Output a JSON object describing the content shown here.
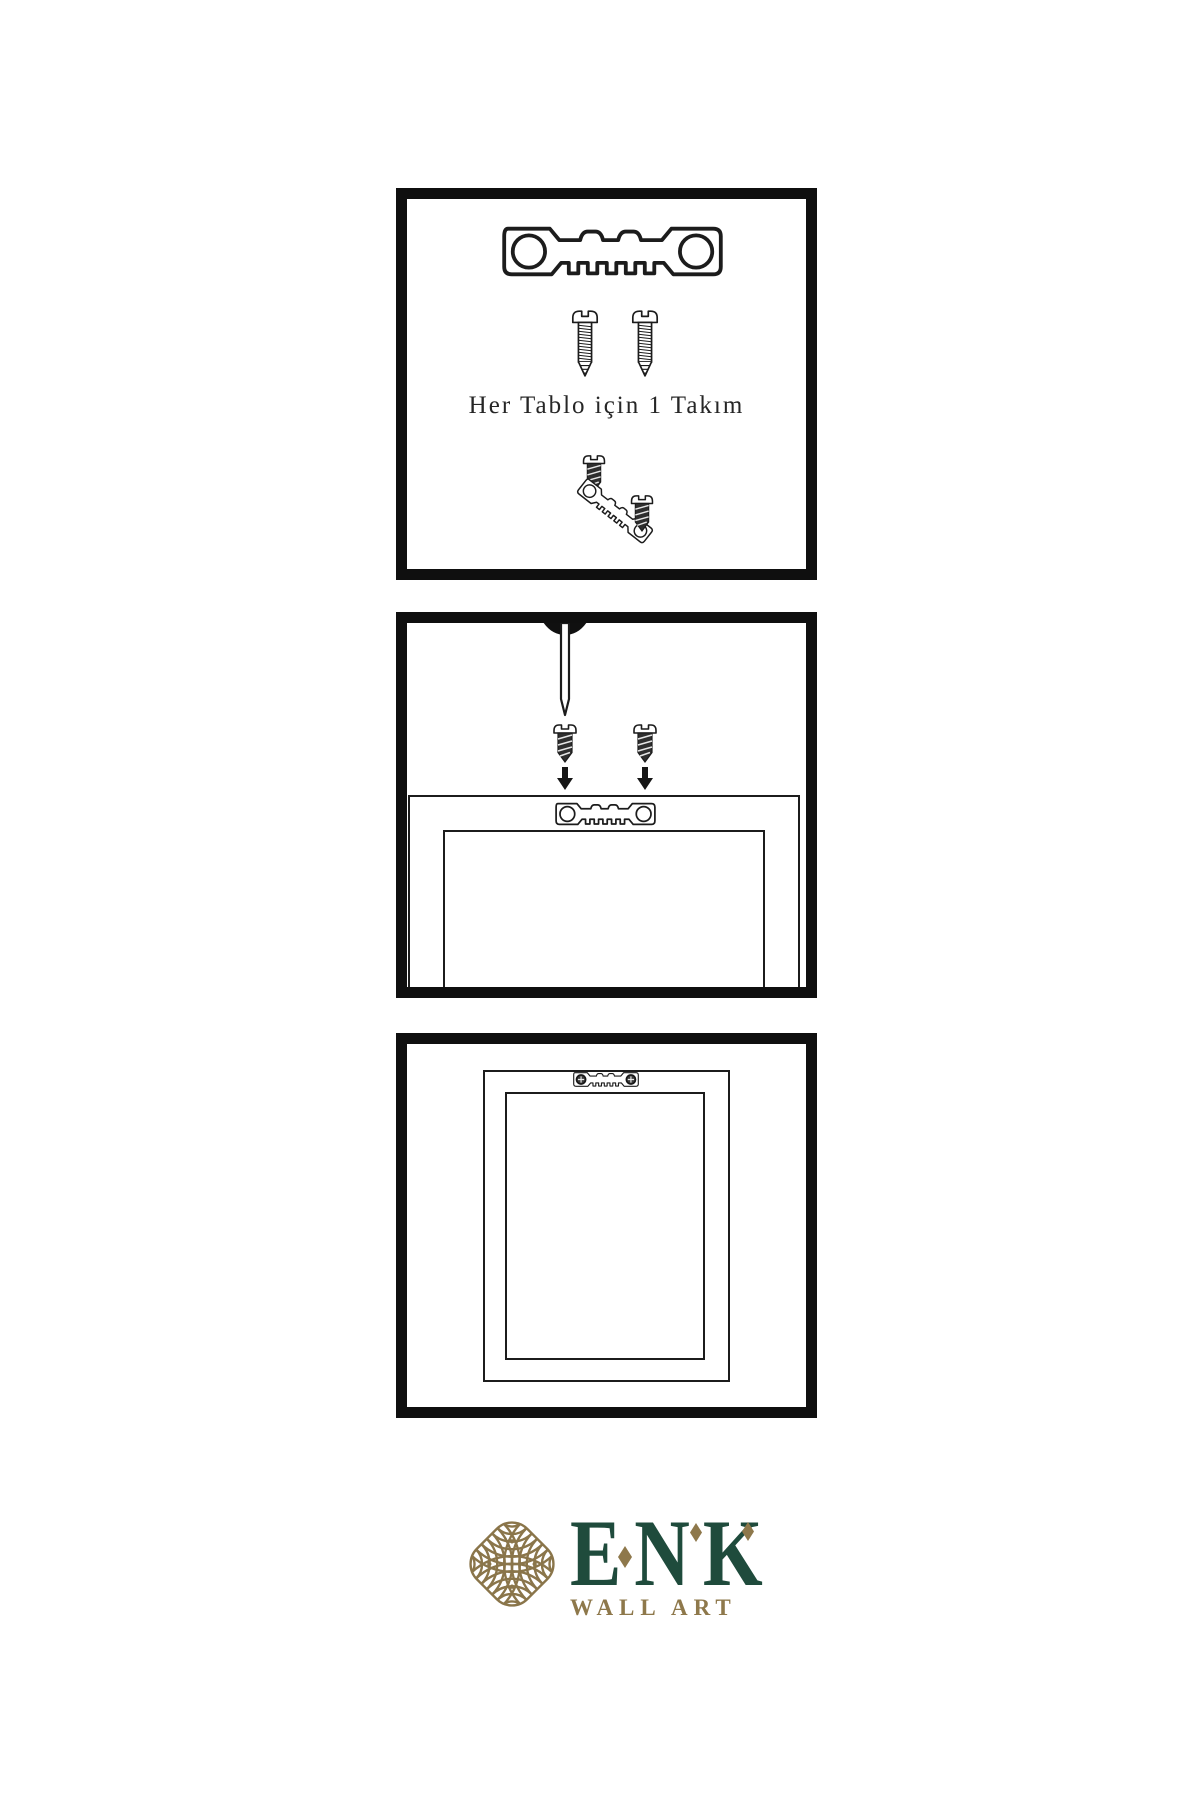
{
  "page": {
    "background": "#ffffff",
    "description_icons": {
      "sawtooth-hanger-icon": "metal sawtooth hanging bracket with two screw holes",
      "screw-icon": "threaded screw, outline style",
      "dark-screw-icon": "threaded screw, dark filled style",
      "nail-icon": "wall nail",
      "wall-anchor-icon": "dark anchor point on wall",
      "arrow-down-icon": "solid downward arrow",
      "frame-back-icon": "back of picture frame",
      "knot-logo-icon": "interlaced gold guilloche knot"
    }
  },
  "panel1": {
    "caption": "Her Tablo için 1 Takım"
  },
  "panel2": {},
  "panel3": {},
  "logo": {
    "brand": "ENK",
    "subtitle": "WALL ART",
    "colors": {
      "green": "#1f4b3c",
      "gold": "#8e784b"
    }
  },
  "colors": {
    "panel_border": "#0f0f0f",
    "line": "#1c1c1c",
    "screw_dark_fill": "#2e2e2e"
  }
}
